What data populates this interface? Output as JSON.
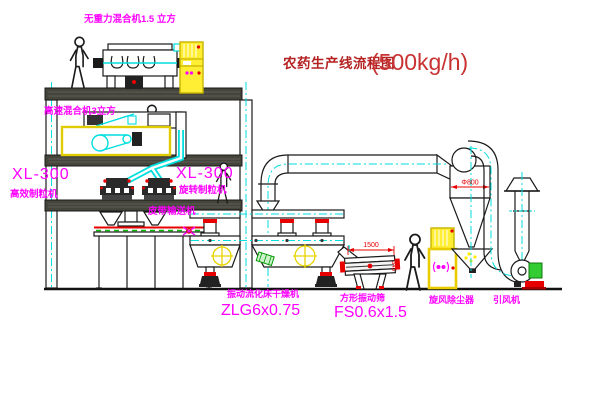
{
  "title": {
    "name": "农药生产线流程图",
    "capacity": "(500kg/h)"
  },
  "equipment_labels": {
    "gravity_mixer": "无重力混合机1.5 立方",
    "high_speed_mixer": "高速混合机3立方",
    "granulator_left_model": "XL-300",
    "granulator_left_name": "高效制粒机",
    "granulator_mid_model": "XL-300",
    "granulator_mid_name": "旋转制粒机",
    "belt_conveyor": "皮带输送机",
    "fluid_bed_dryer_name": "振动流化床干燥机",
    "fluid_bed_dryer_model": "ZLG6x0.75",
    "vibrating_sieve_name": "方形振动筛",
    "vibrating_sieve_model": "FS0.6x1.5",
    "cyclone": "旋风除尘器",
    "induced_draft_fan": "引风机"
  },
  "dimensions": {
    "sieve_length": "1500",
    "sieve_side": "345",
    "cyclone_diameter": "Φ800"
  },
  "colors": {
    "label_magenta": "#ff00ff",
    "title_red": "#c03030",
    "dimension_red": "#e80000",
    "centerline_cyan": "#00dede",
    "cabinet_yellow": "#ffee33",
    "machine_green": "#33cc33",
    "line_dark": "#1a1a1a",
    "background": "#ffffff"
  }
}
